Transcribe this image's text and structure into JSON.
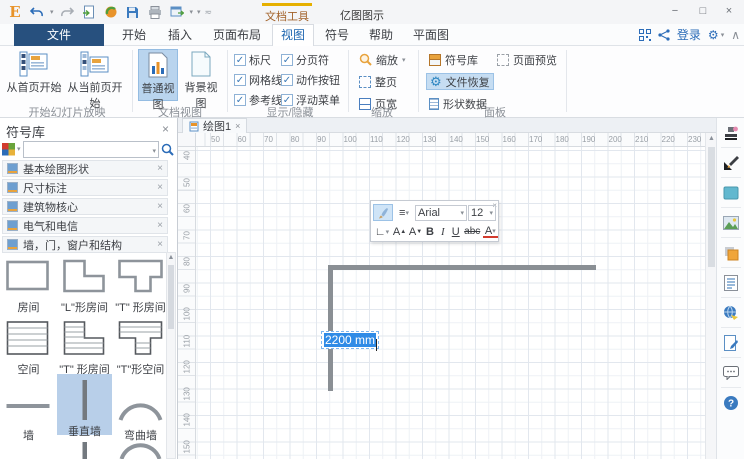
{
  "titlebar": {
    "contextual_tab": "文档工具",
    "app_title": "亿图图示",
    "window_controls": {
      "minimize": "−",
      "maximize": "□",
      "close": "×"
    },
    "qat_icons": [
      "edraw-logo",
      "undo",
      "redo",
      "new-from-template",
      "open",
      "save",
      "print",
      "export-window",
      "customize"
    ]
  },
  "menubar": {
    "tabs": [
      {
        "label": "文件"
      },
      {
        "label": "开始"
      },
      {
        "label": "插入"
      },
      {
        "label": "页面布局"
      },
      {
        "label": "视图"
      },
      {
        "label": "符号"
      },
      {
        "label": "帮助"
      },
      {
        "label": "平面图"
      }
    ],
    "active_tab": "视图",
    "right": {
      "login_label": "登录",
      "icons": [
        "qr-code",
        "share",
        "settings-gear",
        "dropdown",
        "collapse-ribbon"
      ]
    }
  },
  "ribbon": {
    "groups": [
      {
        "label": "开始幻灯片放映",
        "buttons": [
          {
            "label": "从首页开始"
          },
          {
            "label": "从当前页开始"
          }
        ]
      },
      {
        "label": "文档视图",
        "buttons": [
          {
            "label": "普通视图",
            "selected": true
          },
          {
            "label": "背景视图"
          }
        ]
      },
      {
        "label": "显示/隐藏",
        "checkboxes": [
          {
            "label": "标尺",
            "checked": true
          },
          {
            "label": "分页符",
            "checked": true
          },
          {
            "label": "网格线",
            "checked": true
          },
          {
            "label": "动作按钮",
            "checked": true
          },
          {
            "label": "参考线",
            "checked": true
          },
          {
            "label": "浮动菜单",
            "checked": true
          }
        ],
        "checkmark": "✓"
      },
      {
        "label": "缩放",
        "buttons": [
          {
            "label": "缩放"
          },
          {
            "label": "整页"
          },
          {
            "label": "页宽"
          }
        ]
      },
      {
        "label": "面板",
        "buttons": [
          {
            "label": "符号库"
          },
          {
            "label": "页面预览"
          },
          {
            "label": "文件恢复",
            "selected": true
          },
          {
            "label": "形状数据"
          }
        ]
      }
    ]
  },
  "symbol_panel": {
    "title": "符号库",
    "close": "×",
    "search_placeholder": "",
    "categories": [
      {
        "label": "基本绘图形状"
      },
      {
        "label": "尺寸标注"
      },
      {
        "label": "建筑物核心"
      },
      {
        "label": "电气和电信"
      },
      {
        "label": "墙，门，窗户和结构"
      }
    ],
    "shapes": [
      {
        "label": "房间"
      },
      {
        "label": "\"L\"形房间"
      },
      {
        "label": "\"T\" 形房间"
      },
      {
        "label": "空间"
      },
      {
        "label": "\"T\" 形房间"
      },
      {
        "label": "\"T\"形空间"
      },
      {
        "label": "墙"
      },
      {
        "label": "垂直墙",
        "selected": true
      },
      {
        "label": "弯曲墙"
      }
    ]
  },
  "canvas": {
    "tab": "绘图1",
    "tab_close": "×",
    "h_ruler": [
      "50",
      "60",
      "70",
      "80",
      "90",
      "100",
      "110",
      "120",
      "130",
      "140",
      "150",
      "160",
      "170",
      "180",
      "190",
      "200",
      "210",
      "220",
      "230"
    ],
    "v_ruler": [
      "40",
      "50",
      "60",
      "70",
      "80",
      "90",
      "100",
      "110",
      "120",
      "130",
      "140",
      "150"
    ],
    "dimension_label": "2200 mm"
  },
  "floating_toolbar": {
    "font_name": "Arial",
    "font_size": "12",
    "row2": {
      "angle": "∟",
      "grow": "A",
      "shrink": "A",
      "bold": "B",
      "italic": "I",
      "underline": "U",
      "strike": "abc",
      "color": "A"
    },
    "close": "×"
  },
  "right_rail": {
    "icons": [
      "theme-stamp",
      "pencil-style",
      "fill-color",
      "picture",
      "layers",
      "notes-list",
      "hyperlink-globe",
      "edit-document",
      "comment-bubble",
      "help"
    ]
  },
  "colors": {
    "accent": "#1e66b0",
    "selection_blue": "#2f8be6",
    "wall_gray": "#8a8f94",
    "contextual_gold": "#e6b000",
    "file_tab": "#27507e"
  }
}
